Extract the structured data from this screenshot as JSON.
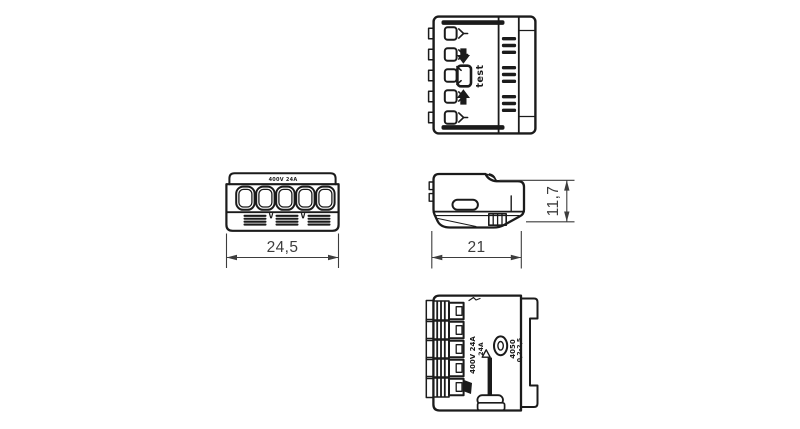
{
  "colors": {
    "line": "#1b1b1b",
    "dimension": "#3d3d3d",
    "background": "#ffffff"
  },
  "dimensions": {
    "width": "24,5",
    "depth": "21",
    "height": "11,7"
  },
  "labels": {
    "test": "test",
    "front_marking": "400V 24A",
    "bottom_rating_line1": "400V 24A",
    "bottom_rating_line2": "24A",
    "bottom_code_line1": "4050",
    "bottom_code_line2": "0,2-2,5"
  }
}
